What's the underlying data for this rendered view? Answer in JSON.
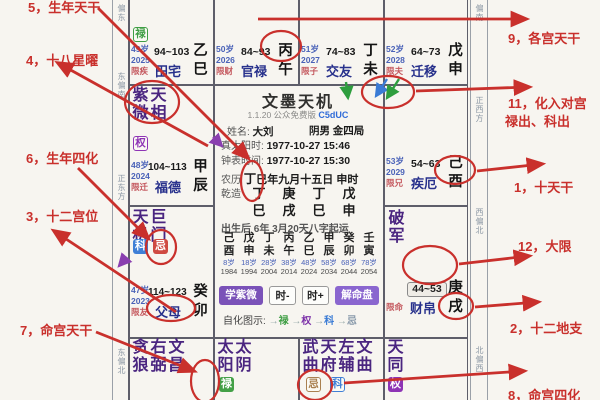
{
  "annotations": {
    "left": {
      "l5": "5，生年天干",
      "l4": "4，十八星曜",
      "l6": "6，生年四化",
      "l3": "3，十二宫位",
      "l7": "7，命宫天干"
    },
    "right": {
      "r9": "9，各宫天干",
      "r11a": "11，化入对宫",
      "r11b": "禄出、科出",
      "r1": "1，十天干",
      "r12": "12，大限",
      "r2": "2，十二地支",
      "r8": "8，命宫四化"
    }
  },
  "compass": {
    "left": [
      "偏东",
      "东偏南",
      "正东方",
      "东偏北"
    ],
    "right": [
      "偏南",
      "正西方",
      "西偏北",
      "北偏西"
    ]
  },
  "palaces": {
    "tianzhai": {
      "age": "49岁",
      "year": "2025",
      "xian": "限疾",
      "range": "94~103",
      "name": "田宅",
      "stem": "乙",
      "branch": "巳",
      "zihua_badge": "禄"
    },
    "guanlu": {
      "age": "50岁",
      "year": "2026",
      "xian": "限财",
      "range": "84~93",
      "name": "官禄",
      "stem": "丙",
      "branch": "午"
    },
    "jiaoyou": {
      "age": "51岁",
      "year": "2027",
      "xian": "限子",
      "range": "74~83",
      "name": "交友",
      "stem": "丁",
      "branch": "未"
    },
    "qianyi": {
      "age": "52岁",
      "year": "2028",
      "xian": "限夫",
      "range": "64~73",
      "name": "迁移",
      "stem": "戊",
      "branch": "申"
    },
    "jieE": {
      "age": "53岁",
      "year": "2029",
      "xian": "限兄",
      "range": "54~63",
      "name": "疾厄",
      "stem": "己",
      "branch": "酉"
    },
    "caibo": {
      "stars": [
        "破军"
      ],
      "xian": "限命",
      "range": "44~53",
      "name": "财帛",
      "stem": "庚",
      "branch": "戌"
    },
    "fude": {
      "age": "48岁",
      "year": "2024",
      "xian": "限迁",
      "range": "104~113",
      "name": "福德",
      "stem": "甲",
      "branch": "辰",
      "stars": [
        "紫微",
        "天相"
      ],
      "zihua_badge": "权"
    },
    "fumu": {
      "age": "47岁",
      "year": "2023",
      "xian": "限友",
      "range": "114~123",
      "name": "父母",
      "stem": "癸",
      "branch": "卯",
      "stars": [
        "天机",
        "巨门"
      ],
      "birth_badges": [
        "科",
        "忌"
      ]
    },
    "ming": {
      "stars": [
        "贪狼",
        "右弼",
        "文昌"
      ]
    },
    "taiyang": {
      "stars": [
        "太阳",
        "太阴"
      ],
      "birth_badges": [
        "禄"
      ]
    },
    "wuqu": {
      "stars": [
        "武曲",
        "天府",
        "左辅",
        "文曲"
      ],
      "zihua_badges": [
        "忌",
        "科"
      ]
    },
    "tiantong": {
      "stars": [
        "天同"
      ],
      "birth_badges": [
        "权"
      ]
    }
  },
  "center": {
    "title": "文墨天机",
    "version": "1.1.20 公众免费版",
    "code": "C5dUC",
    "name_label": "姓名:",
    "name": "大刘",
    "gender": "阴男",
    "wuxing_ju": "金四局",
    "true_solar_label": "真太阳时:",
    "true_solar": "1977-10-27  15:46",
    "clock_label": "钟表时间:",
    "clock": "1977-10-27  15:30",
    "lunar_label": "农历",
    "lunar_stem": "丁",
    "lunar_rest": "巳年九月十五日 申时",
    "qianzao_label": "乾造",
    "bazi_stems": [
      "丁",
      "庚",
      "丁",
      "戊"
    ],
    "bazi_branches": [
      "巳",
      "戌",
      "巳",
      "申"
    ],
    "qiyun": "出生后 6年 3月20天八字起运",
    "dayun_stems": [
      "己",
      "戊",
      "丁",
      "丙",
      "乙",
      "甲",
      "癸",
      "壬"
    ],
    "dayun_branches": [
      "酉",
      "申",
      "未",
      "午",
      "巳",
      "辰",
      "卯",
      "寅"
    ],
    "dayun_ages": [
      "8岁",
      "18岁",
      "28岁",
      "38岁",
      "48岁",
      "58岁",
      "68岁",
      "78岁"
    ],
    "dayun_years": [
      "1984",
      "1994",
      "2004",
      "2014",
      "2024",
      "2034",
      "2044",
      "2054"
    ],
    "buttons": [
      "学紫微",
      "时-",
      "时+",
      "解命盘"
    ],
    "zihua_legend_label": "自化图示:",
    "zihua_arrow": "→",
    "zihua_lu": "禄",
    "zihua_quan": "权",
    "zihua_ke": "科",
    "zihua_ji": "忌"
  },
  "colors": {
    "annotation_red": "#c9302c",
    "lu_green": "#43a047",
    "quan_purple": "#8e34b5",
    "ke_blue": "#3f7fd6",
    "ji_red": "#cf4a42",
    "palace_navy": "#28318c",
    "star_purple": "#4a2580",
    "button_purple": "#7a52b8",
    "age_blue": "#4a62b8"
  }
}
